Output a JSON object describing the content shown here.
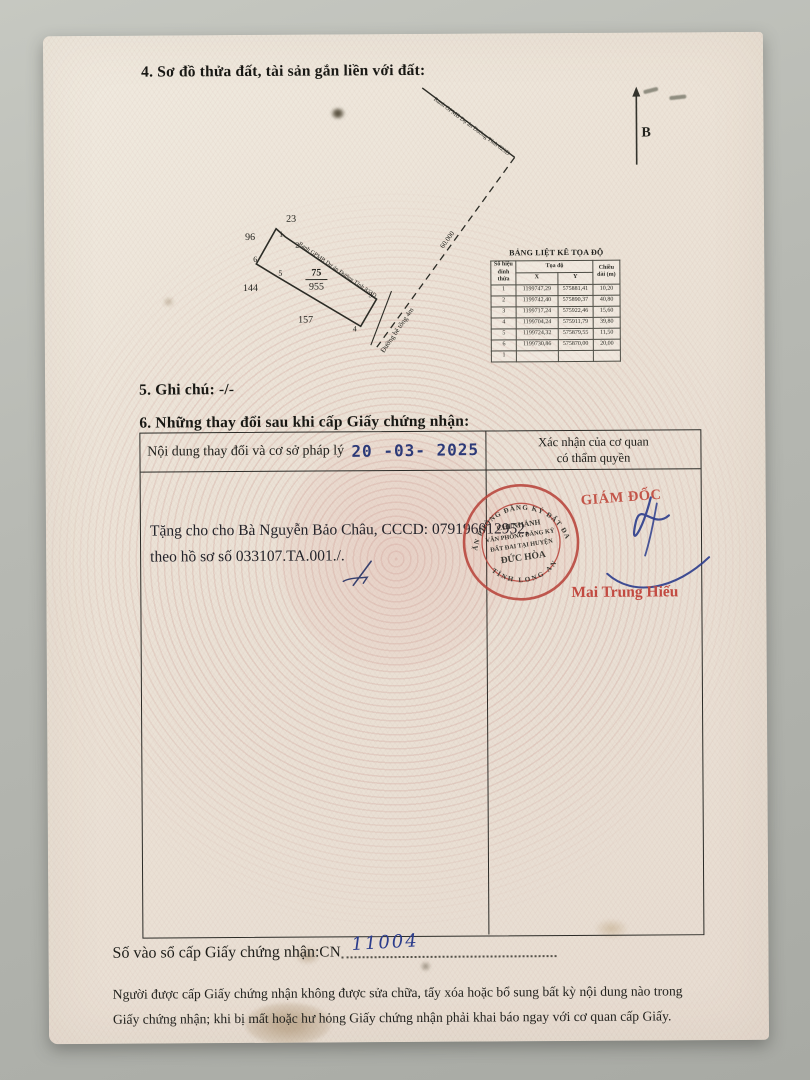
{
  "document": {
    "section4_title": "4. Sơ đồ thửa đất, tài sản gắn liền với đất:",
    "section5_line": "5. Ghi chú: -/-",
    "section6_title": "6. Những thay đổi sau khi cấp Giấy chứng nhận:"
  },
  "diagram": {
    "north_label": "B",
    "parcel_number": "75",
    "parcel_area": "955",
    "neighbor_top": "23",
    "neighbor_left_upper": "96",
    "neighbor_left_lower": "144",
    "neighbor_bottom": "157",
    "vertices": [
      "1",
      "2",
      "3",
      "4",
      "5",
      "6"
    ],
    "boundary_line_label": "Ranh GPMB Dự án Đường Tỉnh 823D",
    "road_label": "Đường bê tông 4m",
    "distance_label": "60.000"
  },
  "coordinate_table": {
    "title": "BẢNG LIỆT KÊ TỌA ĐỘ",
    "header_vertex": "Số hiệu đỉnh thửa",
    "header_coord": "Tọa độ",
    "header_x": "X",
    "header_y": "Y",
    "header_length": "Chiều dài (m)",
    "rows": [
      {
        "id": "1",
        "x": "1199747,29",
        "y": "575881,41",
        "len": "10,20"
      },
      {
        "id": "2",
        "x": "1199742,40",
        "y": "575890,37",
        "len": "40,80"
      },
      {
        "id": "3",
        "x": "1199717,24",
        "y": "575922,46",
        "len": "15,60"
      },
      {
        "id": "4",
        "x": "1199704,24",
        "y": "575911,79",
        "len": "39,80"
      },
      {
        "id": "5",
        "x": "1199724,32",
        "y": "575879,55",
        "len": "11,50"
      },
      {
        "id": "6",
        "x": "1199730,86",
        "y": "575870,00",
        "len": "20,00"
      },
      {
        "id": "1",
        "x": "",
        "y": "",
        "len": ""
      }
    ]
  },
  "changes_table": {
    "header_content": "Nội dung thay đổi và cơ sở pháp lý",
    "date_stamp": "20 -03- 2025",
    "header_confirm_line1": "Xác nhận của cơ quan",
    "header_confirm_line2": "có thẩm quyền",
    "entry_line1": "Tặng cho cho Bà Nguyễn Bảo Châu, CCCD: 079196012952,",
    "entry_line2": "theo hồ sơ số 033107.TA.001./.",
    "approver_title": "GIÁM ĐỐC",
    "approver_name": "Mai Trung Hiếu",
    "stamp": {
      "arc_top": "VĂN PHÒNG ĐĂNG KÝ ĐẤT ĐAI",
      "arc_bottom": "TỈNH LONG AN",
      "line1": "CHI NHÁNH",
      "line2": "VĂN PHÒNG ĐĂNG KÝ",
      "line3": "ĐẤT ĐAI TẠI HUYỆN",
      "line4": "ĐỨC HÒA"
    }
  },
  "footer": {
    "registry_label": "Số vào sổ cấp Giấy chứng nhận:",
    "registry_code": "CN",
    "registry_number": "11004",
    "warning_line1": "Người được cấp Giấy chứng nhận không được sửa chữa, tẩy xóa hoặc bổ sung bất kỳ nội dung nào trong",
    "warning_line2": "Giấy chứng nhận; khi bị mất hoặc hư hỏng Giấy chứng nhận phải khai báo ngay với cơ quan cấp Giấy."
  },
  "colors": {
    "stamp_red": "#b9453c",
    "date_navy": "#2c3a78",
    "signature_blue": "#2b3c8c",
    "paper": "#eae1d4"
  }
}
